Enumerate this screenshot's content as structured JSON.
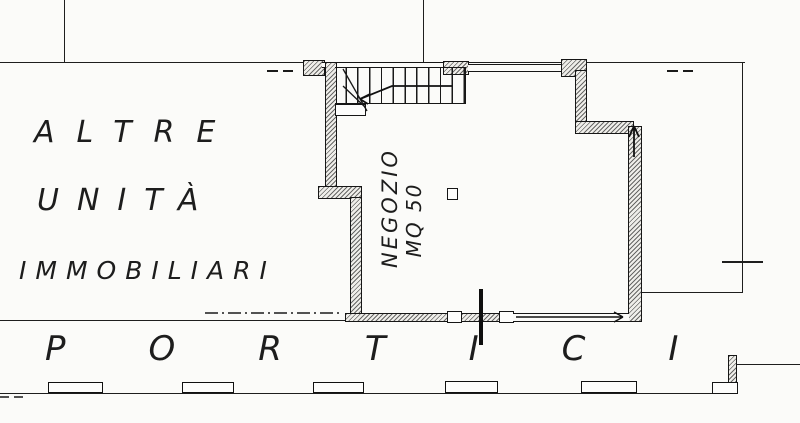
{
  "labels": {
    "adjacent_area": {
      "line1": "ALTRE",
      "line2": "UNITÀ",
      "line3": "IMMOBILIARI"
    },
    "shop": {
      "name": "NEGOZIO",
      "area": "MQ 50"
    },
    "portico": "PORTICI"
  },
  "colors": {
    "ink": "#1c1c1c",
    "paper": "#fbfbf9"
  }
}
